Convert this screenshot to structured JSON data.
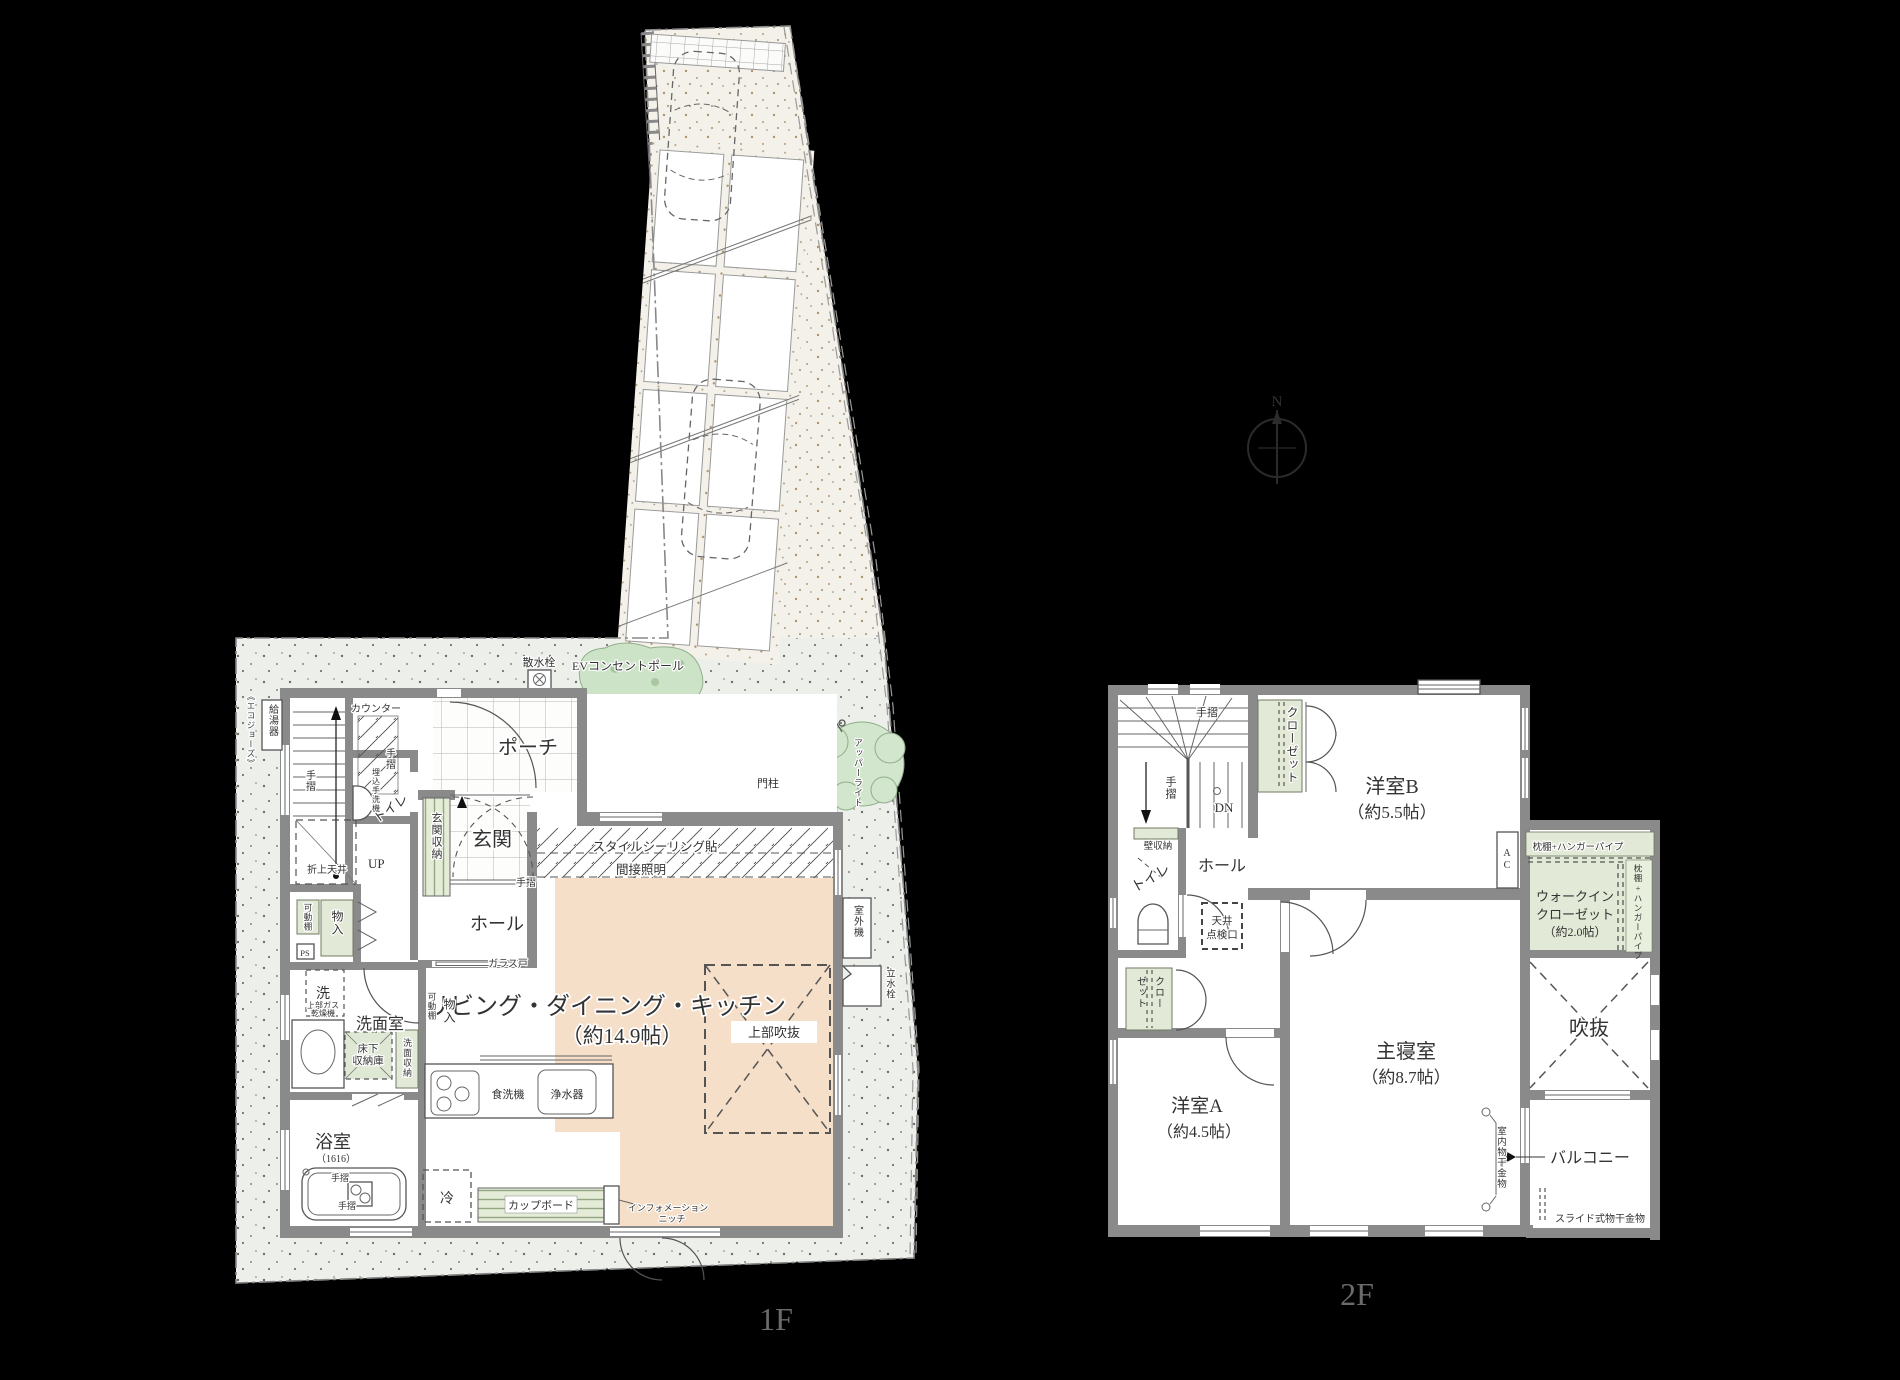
{
  "floor1": {
    "title": "1F",
    "rooms": {
      "ldk": "リビング・ダイニング・キッチン",
      "ldk_size": "（約14.9帖）",
      "genkan": "玄関",
      "hall": "ホール",
      "porch": "ポーチ",
      "washroom": "洗面室",
      "bath": "浴室",
      "bath_size": "（1616）",
      "toilet": "トイレ",
      "up": "UP"
    },
    "labels": {
      "water_heater": "給湯器",
      "eco_jozu": "《エコジョーズ》",
      "sprinkler": "散水栓",
      "ev_pole": "EVコンセントポール",
      "counter": "カウンター",
      "handrail": "手摺",
      "built_in_basin": "埋込手洗機",
      "raised_ceiling": "折上天井",
      "entrance_storage": "玄関収納",
      "movable_shelf": "可動棚",
      "storage": "物入",
      "ps": "PS",
      "glass_door": "ガラス戸",
      "washer": "洗",
      "gas_dryer_1": "上部ガス",
      "gas_dryer_2": "乾燥機",
      "underfloor_1": "床下",
      "underfloor_2": "収納庫",
      "vanity_storage": "洗面収納",
      "dishwasher": "食洗機",
      "water_purifier": "浄水器",
      "fridge": "冷",
      "cupboard": "カップボード",
      "niche_1": "インフォメーション",
      "niche_2": "ニッチ",
      "style_ceiling": "スタイルシーリング貼",
      "indirect_light": "間接照明",
      "void_above": "上部吹抜",
      "outdoor_unit": "室外機",
      "tap": "立水栓",
      "gate_post": "門柱",
      "upper_light": "アッパーライト"
    }
  },
  "floor2": {
    "title": "2F",
    "rooms": {
      "bedroom": "主寝室",
      "bedroom_size": "（約8.7帖）",
      "room_a": "洋室A",
      "room_a_size": "（約4.5帖）",
      "room_b": "洋室B",
      "room_b_size": "（約5.5帖）",
      "wic_1": "ウォークイン",
      "wic_2": "クローゼット",
      "wic_size": "（約2.0帖）",
      "void": "吹抜",
      "balcony": "バルコニー",
      "hall": "ホール",
      "toilet": "トイレ"
    },
    "labels": {
      "handrail": "手摺",
      "dn": "DN",
      "closet": "クローゼット",
      "closet_a1": "クロー",
      "closet_a2": "ゼット",
      "wall_storage": "壁収納",
      "ceiling_access_1": "天井",
      "ceiling_access_2": "点検口",
      "ac": "AC",
      "pillow_shelf": "枕棚+ハンガーパイプ",
      "indoor_hanger": "室内物干金物",
      "slide_hanger": "スライド式物干金物"
    }
  },
  "compass": {
    "north": "N"
  }
}
